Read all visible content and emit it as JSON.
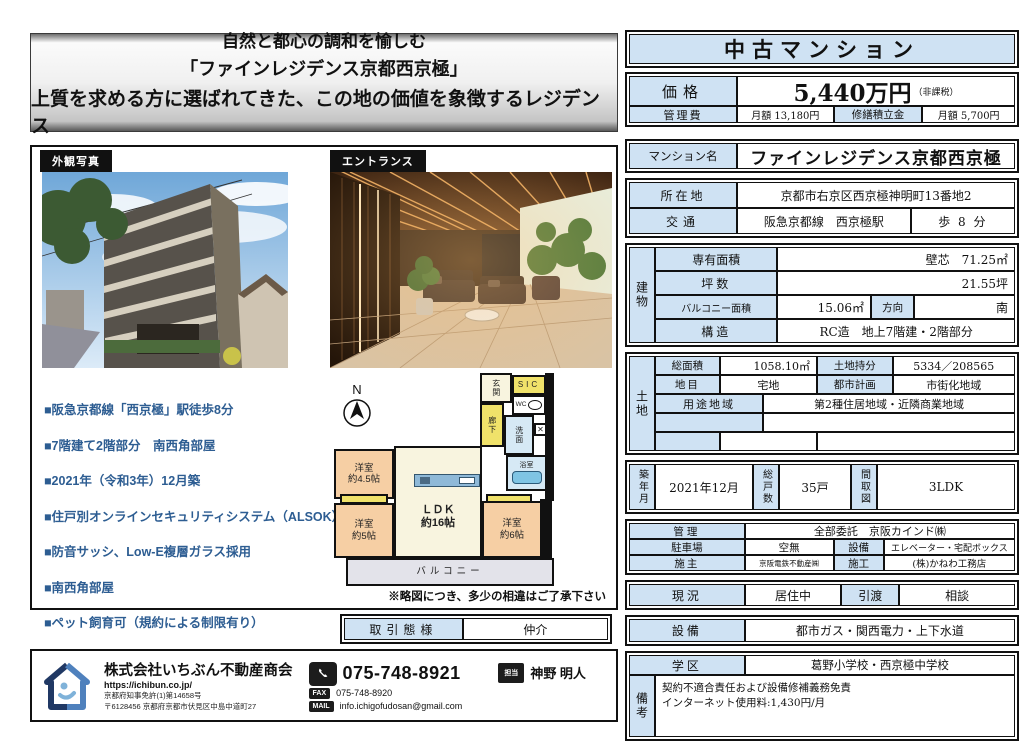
{
  "banner": {
    "line1": "自然と都心の調和を愉しむ",
    "line2": "「ファインレジデンス京都西京極」",
    "line3": "上質を求める方に選ばれてきた、この地の価値を象徴するレジデンス"
  },
  "photos": {
    "exterior_label": "外観写真",
    "entrance_label": "エントランス"
  },
  "features": [
    "■阪急京都線「西京極」駅徒歩8分",
    "■7階建て2階部分　南西角部屋",
    "■2021年（令和3年）12月築",
    "■住戸別オンラインセキュリティシステム（ALSOK）",
    "■防音サッシ、Low-E複層ガラス採用",
    "■南西角部屋",
    "■ペット飼育可（規約による制限有り）",
    "■24時間ゴミ出し可能"
  ],
  "floorplan": {
    "compass": "N",
    "rooms": {
      "genkan": "玄関",
      "sic": "SIC",
      "wc": "WC",
      "rouka": "廊下",
      "senmen": "洗面",
      "yokushitsu": "浴室",
      "bed45_l1": "洋室",
      "bed45_l2": "約4.5帖",
      "bed5_l1": "洋室",
      "bed5_l2": "約5帖",
      "ldk_l1": "ＬＤＫ",
      "ldk_l2": "約16帖",
      "bed6_l1": "洋室",
      "bed6_l2": "約6帖",
      "balcony": "バルコニー"
    },
    "note": "※略図につき、多少の相違はご了承下さい"
  },
  "transaction": {
    "label": "取引態様",
    "value": "仲介"
  },
  "footer": {
    "company": "株式会社いちぶん不動産商会",
    "url": "https://ichibun.co.jp/",
    "license": "京都府知事免許(1)第14658号",
    "address": "〒6128456 京都府京都市伏見区中島中道町27",
    "phone": "075-748-8921",
    "fax_label": "FAX",
    "fax": "075-748-8920",
    "mail_label": "MAIL",
    "mail": "info.ichigofudosan@gmail.com",
    "agent_label": "担当",
    "agent_name": "神野 明人"
  },
  "listing": {
    "type_header": "中古マンション",
    "price": {
      "label": "価格",
      "value": "5,440万円",
      "tax_note": "（非課税）",
      "kanrihi_label": "管理費",
      "kanrihi_value": "月額 13,180円",
      "shuzen_label": "修繕積立金",
      "shuzen_value": "月額 5,700円"
    },
    "name": {
      "label": "マンション名",
      "value": "ファインレジデンス京都西京極"
    },
    "location": {
      "label": "所在地",
      "value": "京都市右京区西京極神明町13番地2",
      "kotsu_label": "交通",
      "line": "阪急京都線　西京極駅",
      "walk": "歩 8 分"
    },
    "building": {
      "group": "建物",
      "senyu_label": "専有面積",
      "senyu_value": "壁芯　71.25㎡",
      "tsubo_label": "坪数",
      "tsubo_value": "21.55坪",
      "balcony_label": "バルコニー面積",
      "balcony_value": "15.06㎡",
      "hoko_label": "方向",
      "hoko_value": "南",
      "kozo_label": "構造",
      "kozo_value": "RC造　地上7階建・2階部分"
    },
    "land": {
      "group": "土地",
      "somenseki_label": "総面積",
      "somenseki_value": "1058.10㎡",
      "mochibun_label": "土地持分",
      "mochibun_value": "5334／208565",
      "chimoku_label": "地目",
      "chimoku_value": "宅地",
      "toshi_label": "都市計画",
      "toshi_value": "市街化地域",
      "yoto_label": "用途地域",
      "yoto_value": "第2種住居地域・近隣商業地域"
    },
    "overview": {
      "chiku_label": "築年月",
      "chiku_value": "2021年12月",
      "kosu_label": "総戸数",
      "kosu_value": "35戸",
      "madori_label": "間取図",
      "madori_value": "3LDK"
    },
    "management": {
      "kanri_label": "管理",
      "kanri_value": "全部委託　京阪カインド㈱",
      "parking_label": "駐車場",
      "parking_value": "空無",
      "setsubi_label": "設備",
      "setsubi_value": "エレベーター・宅配ボックス",
      "sesyu_label": "施主",
      "sesyu_value": "京阪電鉄不動産㈱",
      "seko_label": "施工",
      "seko_value": "(株)かねわ工務店"
    },
    "status": {
      "genkyo_label": "現況",
      "genkyo_value": "居住中",
      "hikiwatashi_label": "引渡",
      "hikiwatashi_value": "相談"
    },
    "utilities": {
      "label": "設備",
      "value": "都市ガス・関西電力・上下水道"
    },
    "school": {
      "label": "学区",
      "value": "葛野小学校・西京極中学校"
    },
    "remarks": {
      "label": "備考",
      "line1": "契約不適合責任および設備修補義務免責",
      "line2": "インターネット使用料:1,430円/月"
    }
  }
}
